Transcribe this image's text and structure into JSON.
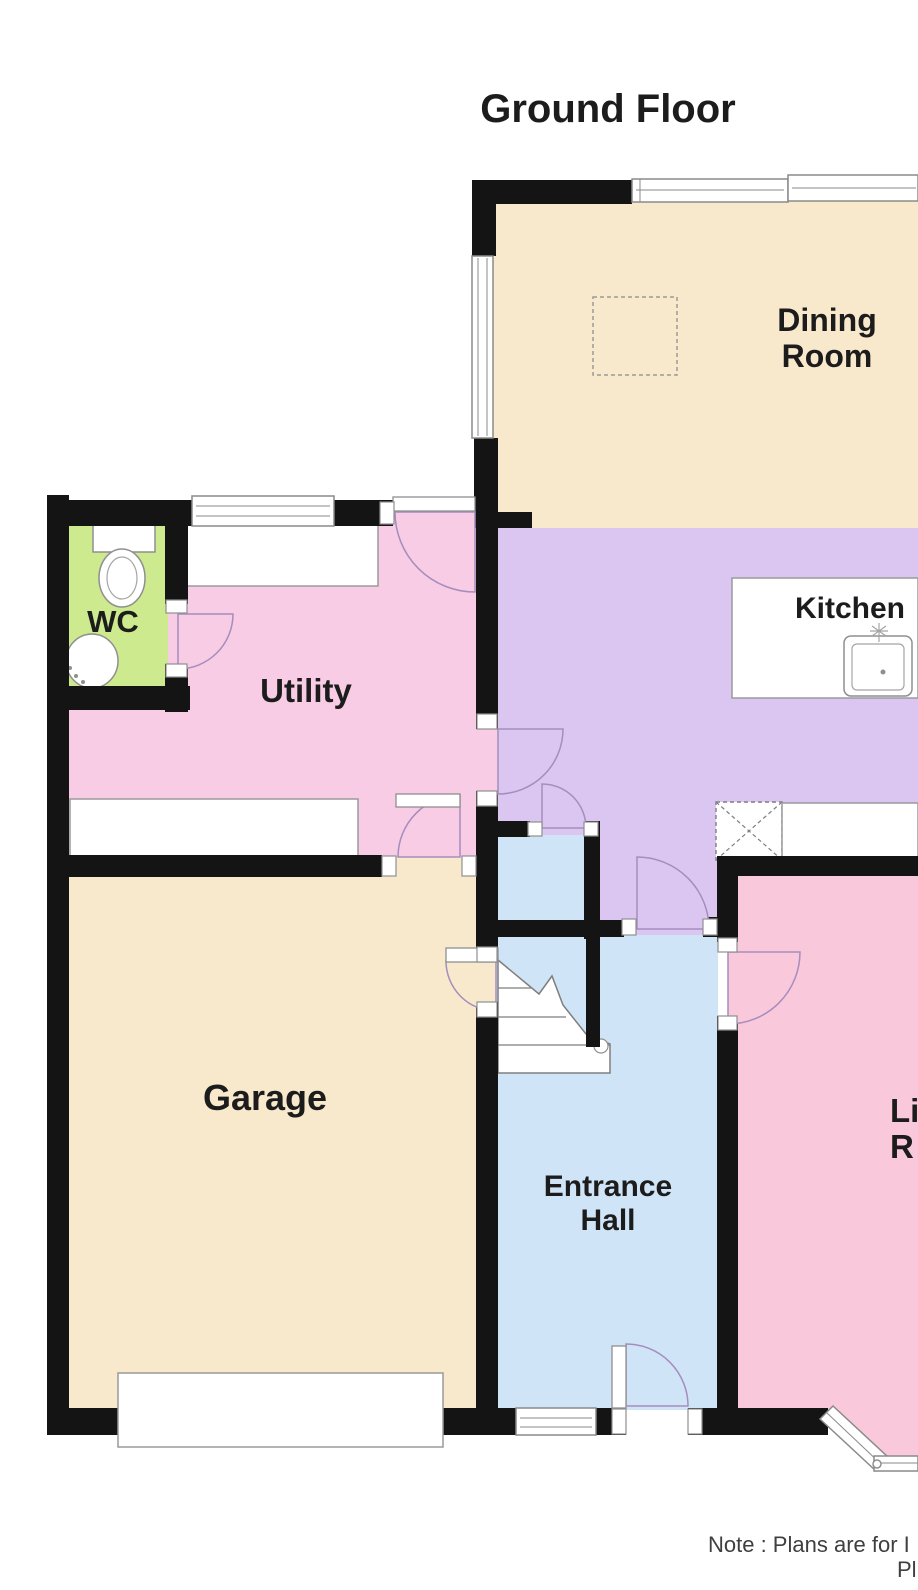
{
  "title": "Ground Floor",
  "colors": {
    "wall": "#141414",
    "cream": "#f8e9cc",
    "kitchen": "#dbc6f1",
    "utility": "#f7cce4",
    "living": "#f9c8da",
    "hall": "#cfe4f6",
    "wc": "#cdeb8e",
    "outline": "#8a8a8a",
    "door": "#a58dbd",
    "ink": "#1c1c1c",
    "noteink": "#3f3f3f"
  },
  "rooms": {
    "dining": {
      "line1": "Dining",
      "line2": "Room"
    },
    "kitchen": {
      "label": "Kitchen"
    },
    "utility": {
      "label": "Utility"
    },
    "wc": {
      "label": "WC"
    },
    "garage": {
      "label": "Garage"
    },
    "hall": {
      "line1": "Entrance",
      "line2": "Hall"
    },
    "living": {
      "line1": "Li",
      "line2": "R"
    }
  },
  "note": {
    "line1": "Note : Plans are for I",
    "line2": "Pl"
  }
}
